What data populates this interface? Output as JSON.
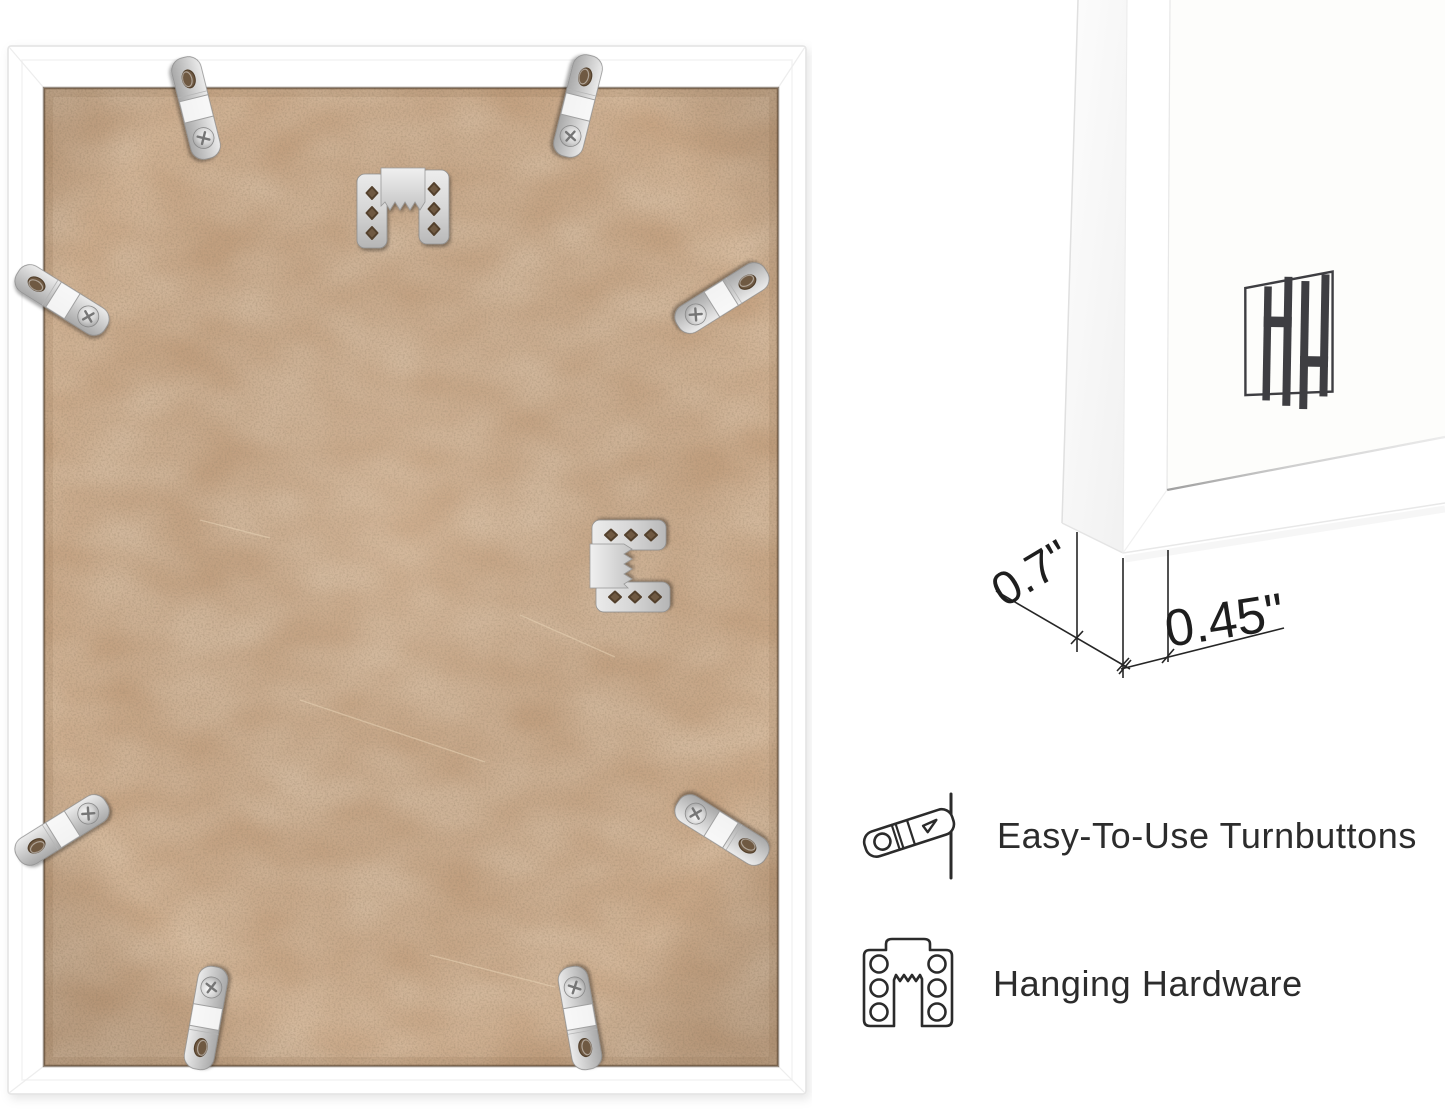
{
  "image": {
    "width": 1445,
    "height": 1114,
    "background": "#ffffff"
  },
  "frame_back_photo": {
    "subject": "white picture frame rear view with MDF backing",
    "frame_color": "#ffffff",
    "backing_color": "#c5a281",
    "hardware_color": "#cccccc",
    "turnbutton_count": 8,
    "sawtooth_hanger_count": 2
  },
  "corner_photo": {
    "subject": "white frame corner close-up with mat",
    "logo_icon": "hh-bars-monogram",
    "logo_color": "#3e3e42",
    "measurements": {
      "depth": "0.7\"",
      "face": "0.45\""
    }
  },
  "features": [
    {
      "icon": "turnbutton-icon",
      "label": "Easy-To-Use Turnbuttons"
    },
    {
      "icon": "sawtooth-hanger-icon",
      "label": "Hanging Hardware"
    }
  ],
  "colors": {
    "text": "#2c2c2c",
    "dimension_lines": "#262626",
    "metal_dark": "#a9a9a9",
    "hole_shadow": "#6f5942"
  }
}
